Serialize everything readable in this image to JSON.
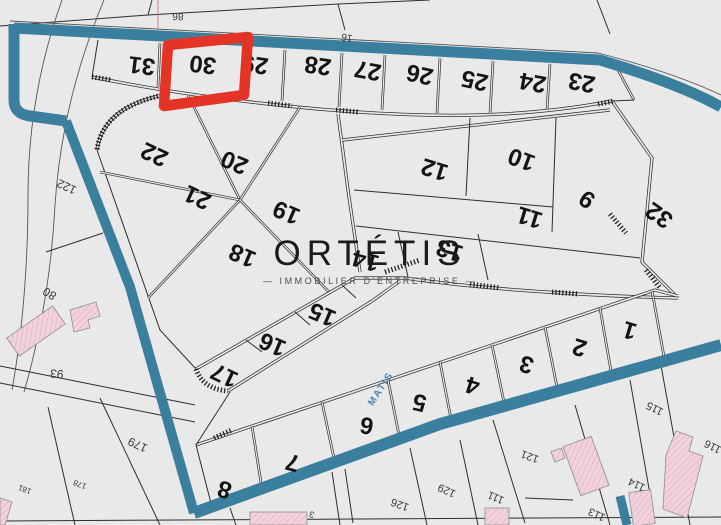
{
  "watermark": {
    "brand": "ORTÉTIS",
    "tagline": "IMMOBILIER D'ENTREPRISE",
    "tagline_display": "—   IMMOBILIER D'ENTREPRISE   —"
  },
  "highlight": {
    "parcel": "30",
    "color": "#e43426"
  },
  "street": {
    "name": "MATIS",
    "color": "#4a86b8"
  },
  "colors": {
    "background": "#e9e9e9",
    "zone_boundary": "#3a7f9d",
    "parcel_line": "#2e2e2e",
    "building_fill": "#f2d2de",
    "building_hatch": "#dfb3c6",
    "highlight_red": "#e43426"
  },
  "parcels": [
    {
      "label": "31",
      "x": 142,
      "y": 64,
      "r": 187
    },
    {
      "label": "30",
      "x": 203,
      "y": 63,
      "r": 187
    },
    {
      "label": "29",
      "x": 255,
      "y": 63,
      "r": 188
    },
    {
      "label": "28",
      "x": 318,
      "y": 64,
      "r": 188
    },
    {
      "label": "27",
      "x": 368,
      "y": 69,
      "r": 190
    },
    {
      "label": "26",
      "x": 420,
      "y": 73,
      "r": 192
    },
    {
      "label": "25",
      "x": 475,
      "y": 79,
      "r": 192
    },
    {
      "label": "24",
      "x": 533,
      "y": 81,
      "r": 190
    },
    {
      "label": "23",
      "x": 582,
      "y": 81,
      "r": 190
    },
    {
      "label": "22",
      "x": 155,
      "y": 153,
      "r": 205
    },
    {
      "label": "21",
      "x": 198,
      "y": 196,
      "r": 205
    },
    {
      "label": "20",
      "x": 235,
      "y": 161,
      "r": 203
    },
    {
      "label": "19",
      "x": 287,
      "y": 211,
      "r": 203
    },
    {
      "label": "18",
      "x": 243,
      "y": 254,
      "r": 203
    },
    {
      "label": "12",
      "x": 435,
      "y": 168,
      "r": 197
    },
    {
      "label": "10",
      "x": 522,
      "y": 158,
      "r": 200
    },
    {
      "label": "11",
      "x": 530,
      "y": 216,
      "r": 197
    },
    {
      "label": "9",
      "x": 588,
      "y": 198,
      "r": 215
    },
    {
      "label": "32",
      "x": 660,
      "y": 214,
      "r": 215
    },
    {
      "label": "13",
      "x": 450,
      "y": 249,
      "r": 197
    },
    {
      "label": "14",
      "x": 366,
      "y": 259,
      "r": 195
    },
    {
      "label": "15",
      "x": 323,
      "y": 313,
      "r": 203
    },
    {
      "label": "16",
      "x": 273,
      "y": 343,
      "r": 203
    },
    {
      "label": "17",
      "x": 225,
      "y": 374,
      "r": 205
    },
    {
      "label": "8",
      "x": 225,
      "y": 488,
      "r": 197
    },
    {
      "label": "7",
      "x": 293,
      "y": 461,
      "r": 195
    },
    {
      "label": "6",
      "x": 367,
      "y": 424,
      "r": 190
    },
    {
      "label": "5",
      "x": 420,
      "y": 401,
      "r": 193
    },
    {
      "label": "4",
      "x": 473,
      "y": 384,
      "r": 197
    },
    {
      "label": "3",
      "x": 527,
      "y": 363,
      "r": 197
    },
    {
      "label": "2",
      "x": 580,
      "y": 346,
      "r": 197
    },
    {
      "label": "1",
      "x": 630,
      "y": 329,
      "r": 197
    }
  ],
  "peripheral_labels": [
    {
      "label": "86",
      "x": 178,
      "y": 16,
      "r": 183,
      "size": 10
    },
    {
      "label": "16",
      "x": 347,
      "y": 37,
      "r": 190,
      "size": 10
    },
    {
      "label": "122",
      "x": 67,
      "y": 186,
      "r": 205,
      "size": 12
    },
    {
      "label": "80",
      "x": 50,
      "y": 293,
      "r": 212,
      "size": 12
    },
    {
      "label": "93",
      "x": 57,
      "y": 373,
      "r": 185,
      "size": 12
    },
    {
      "label": "179",
      "x": 138,
      "y": 444,
      "r": 205,
      "size": 12
    },
    {
      "label": "178",
      "x": 80,
      "y": 484,
      "r": 200,
      "size": 8
    },
    {
      "label": "181",
      "x": 25,
      "y": 489,
      "r": 200,
      "size": 8
    },
    {
      "label": "3",
      "x": 312,
      "y": 514,
      "r": 195,
      "size": 9
    },
    {
      "label": "126",
      "x": 400,
      "y": 504,
      "r": 200,
      "size": 11
    },
    {
      "label": "129",
      "x": 447,
      "y": 490,
      "r": 205,
      "size": 11
    },
    {
      "label": "111",
      "x": 496,
      "y": 497,
      "r": 203,
      "size": 11
    },
    {
      "label": "121",
      "x": 530,
      "y": 456,
      "r": 200,
      "size": 11
    },
    {
      "label": "113",
      "x": 597,
      "y": 514,
      "r": 205,
      "size": 11
    },
    {
      "label": "114",
      "x": 637,
      "y": 484,
      "r": 207,
      "size": 11
    },
    {
      "label": "115",
      "x": 655,
      "y": 408,
      "r": 207,
      "size": 11
    },
    {
      "label": "116",
      "x": 713,
      "y": 446,
      "r": 207,
      "size": 11
    }
  ]
}
